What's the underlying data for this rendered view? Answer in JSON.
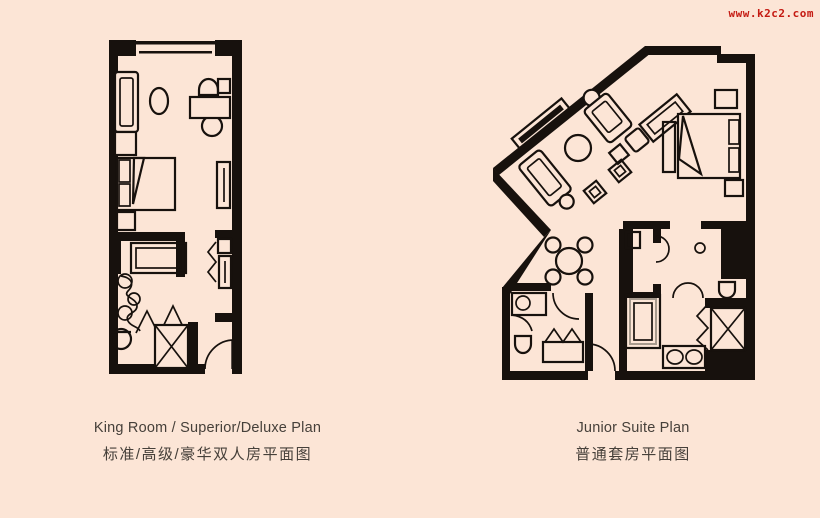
{
  "colors": {
    "background": "#fce5d6",
    "ink": "#17110d",
    "caption_text": "#46403a",
    "watermark_red": "#c41a12"
  },
  "watermark": {
    "text": "www.k2c2.com"
  },
  "plans": [
    {
      "id": "king-room",
      "caption_en": "King Room / Superior/Deluxe Plan",
      "caption_zh": "标准/高级/豪华双人房平面图"
    },
    {
      "id": "junior-suite",
      "caption_en": "Junior Suite Plan",
      "caption_zh": "普通套房平面图"
    }
  ]
}
